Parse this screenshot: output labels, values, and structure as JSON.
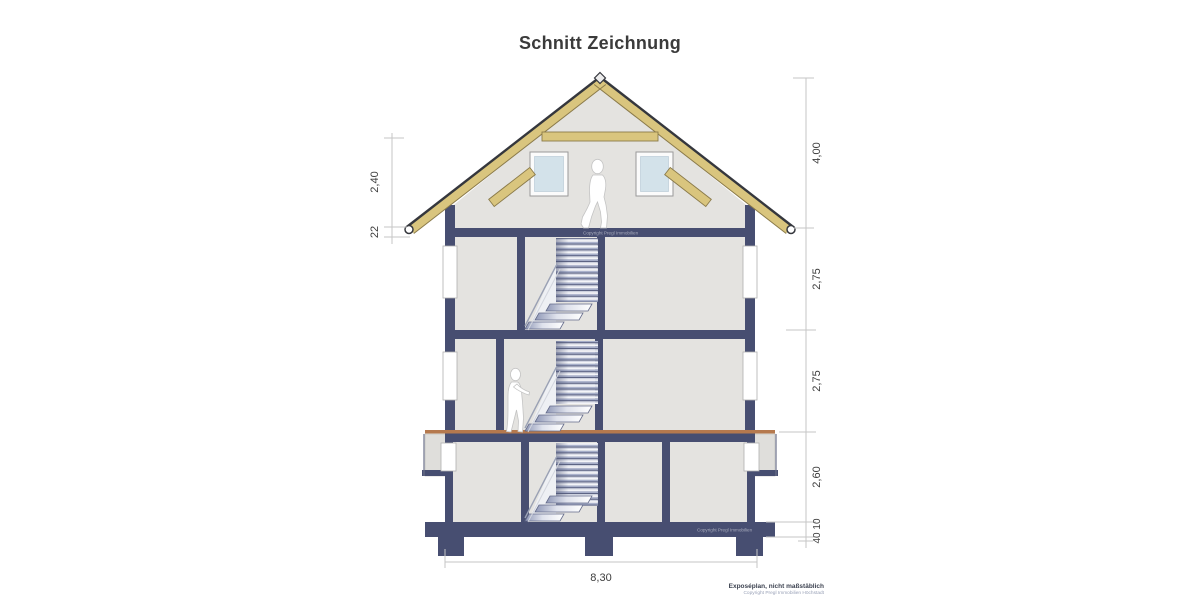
{
  "title": "Schnitt Zeichnung",
  "dims": {
    "left": [
      "2,40",
      "22"
    ],
    "right": [
      "4,00",
      "2,75",
      "2,75",
      "2,60",
      "40 10"
    ],
    "bottom": "8,30"
  },
  "footer": {
    "note": "Exposéplan, nicht maßstäblich",
    "copyright": "Copyright Pregl Immobilien Höchstadt"
  },
  "watermarks": {
    "upper_slab": "Copyright Pregl Immobilien",
    "lower_slab": "Copyright Pregl Immobilien"
  },
  "colors": {
    "structure": "#474e71",
    "roof_timber": "#d9c57e",
    "roof_edge": "#35373d",
    "interior": "#e4e3e0",
    "terrain": "#b5794e",
    "glass": "#d3e2ea",
    "dimension_line": "#c6c6c6"
  }
}
